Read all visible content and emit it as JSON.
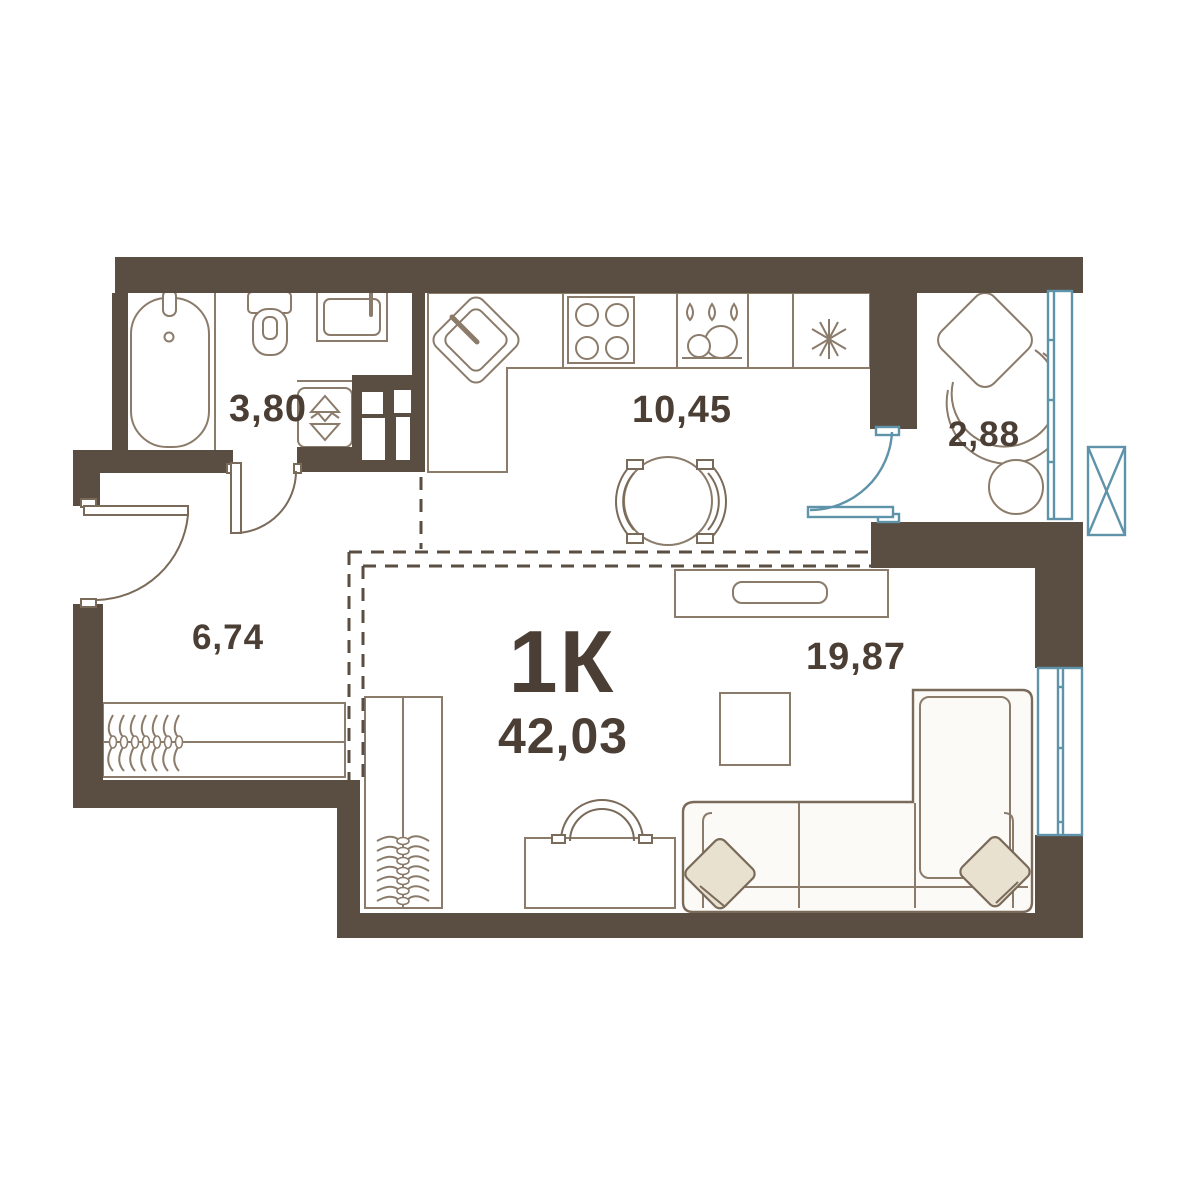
{
  "apartment": {
    "type_label": "1К",
    "total_area_label": "42,03"
  },
  "rooms": [
    {
      "id": "bathroom",
      "area_label": "3,80"
    },
    {
      "id": "kitchen-dining",
      "area_label": "10,45"
    },
    {
      "id": "balcony",
      "area_label": "2,88"
    },
    {
      "id": "hallway",
      "area_label": "6,74"
    },
    {
      "id": "living-area",
      "area_label": "19,87"
    }
  ],
  "colors": {
    "wall": "#5a4e43",
    "furniture_outline": "#8b7b6a",
    "glazing_blue": "#5f93a9",
    "label_text": "#4b3e34",
    "pillow_beige": "#e8e1cf",
    "background": "#ffffff"
  }
}
